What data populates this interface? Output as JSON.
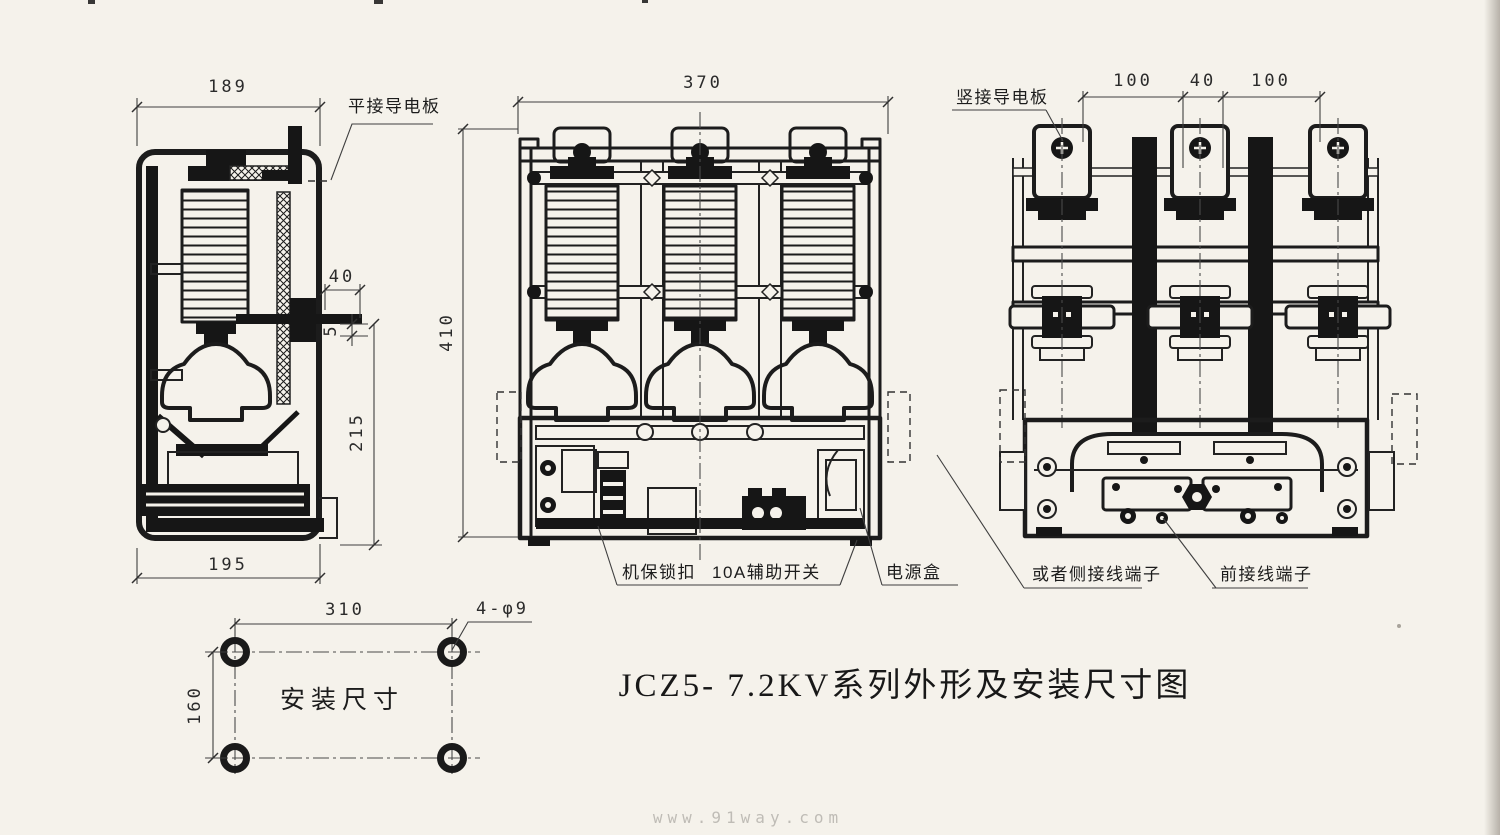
{
  "title": "JCZ5- 7.2KV系列外形及安装尺寸图",
  "watermark": "www.91way.com",
  "side_view": {
    "dim_width_top": "189",
    "dim_pin": "40",
    "dim_gap": "5",
    "dim_height_lower": "215",
    "dim_width_bottom": "195",
    "label_flat_plate": "平接导电板"
  },
  "front_view": {
    "dim_width": "370",
    "dim_height": "410",
    "label_mech_lock": "机保锁扣",
    "label_aux_switch": "10A辅助开关",
    "label_power_box": "电源盒"
  },
  "rear_view": {
    "label_vertical_plate": "竖接导电板",
    "dim_left": "100",
    "dim_center": "40",
    "dim_right": "100",
    "label_side_terminal": "或者侧接线端子",
    "label_front_terminal": "前接线端子"
  },
  "mounting": {
    "dim_width": "310",
    "dim_height": "160",
    "hole_spec": "4-φ9",
    "label": "安装尺寸"
  }
}
